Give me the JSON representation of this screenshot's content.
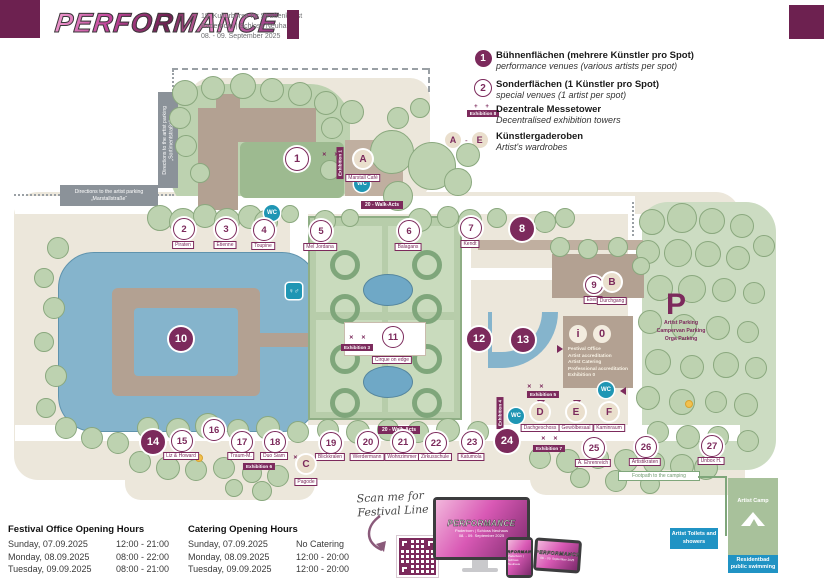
{
  "colors": {
    "purple": "#7c2a5c",
    "teal_wc": "#1f96b4",
    "blue_box": "#2093c4",
    "camp_green": "#a8c19b",
    "water": "#85b4cc"
  },
  "header": {
    "logo_text": "PERFORMANCE",
    "subtitle1": "19. Kulturbörse für Straßenkunst",
    "subtitle2": "Paderborn | Schloss Neuhaus",
    "subtitle3": "08. - 09. September 2025"
  },
  "legend": {
    "items": [
      {
        "symbol": "1",
        "title": "Bühnenflächen (mehrere Künstler pro Spot)",
        "subtitle": "performance venues (various artists per spot)"
      },
      {
        "symbol": "2",
        "title": "Sonderflächen (1 Künstler pro Spot)",
        "subtitle": "special venues (1 artist per spot)"
      },
      {
        "symbol": "Exhibition 8",
        "marks": "+ +",
        "title": "Dezentrale Messetower",
        "subtitle": "Decentralised exhibition towers"
      },
      {
        "symbol_a": "A",
        "symbol_dash": "-",
        "symbol_e": "E",
        "title": "Künstlergaderoben",
        "subtitle": "Artist's wardrobes"
      }
    ]
  },
  "map": {
    "walk_acts_label": "20 - Walk-Acts",
    "walk_acts_badges": [
      {
        "x": 382,
        "y": 201
      },
      {
        "x": 399,
        "y": 426
      }
    ],
    "wc_label": "WC",
    "wc": [
      {
        "x": 272,
        "y": 213
      },
      {
        "x": 362,
        "y": 184
      },
      {
        "x": 516,
        "y": 416
      },
      {
        "x": 606,
        "y": 390
      }
    ],
    "toilet_icon": {
      "x": 294,
      "y": 291,
      "glyphs": "♀♂"
    },
    "spots": [
      {
        "n": "1",
        "x": 296,
        "y": 158,
        "r": 11,
        "filled": false
      },
      {
        "n": "2",
        "x": 183,
        "y": 228,
        "r": 10,
        "filled": false,
        "label": "Piraten",
        "ly": 241
      },
      {
        "n": "3",
        "x": 225,
        "y": 228,
        "r": 10,
        "filled": false,
        "label": "Etienne",
        "ly": 241
      },
      {
        "n": "4",
        "x": 263,
        "y": 229,
        "r": 10,
        "filled": false,
        "label": "Toupine",
        "ly": 242
      },
      {
        "n": "5",
        "x": 320,
        "y": 230,
        "r": 10,
        "filled": false,
        "label": "Mel Jordana",
        "ly": 243
      },
      {
        "n": "6",
        "x": 408,
        "y": 230,
        "r": 10,
        "filled": false,
        "label": "Balagans",
        "ly": 243
      },
      {
        "n": "7",
        "x": 470,
        "y": 227,
        "r": 10,
        "filled": false,
        "label": "Kendt",
        "ly": 240
      },
      {
        "n": "8",
        "x": 521,
        "y": 228,
        "r": 11,
        "filled": true
      },
      {
        "n": "9",
        "x": 593,
        "y": 284,
        "r": 8,
        "filled": false,
        "label": "Exent",
        "ly": 296
      },
      {
        "n": "10",
        "x": 180,
        "y": 338,
        "r": 11,
        "filled": true
      },
      {
        "n": "11",
        "x": 392,
        "y": 336,
        "r": 10,
        "filled": false,
        "label": "Cirque on edge",
        "ly": 356
      },
      {
        "n": "12",
        "x": 478,
        "y": 338,
        "r": 11,
        "filled": true
      },
      {
        "n": "13",
        "x": 522,
        "y": 339,
        "r": 11,
        "filled": true
      },
      {
        "n": "14",
        "x": 152,
        "y": 441,
        "r": 11,
        "filled": true
      },
      {
        "n": "15",
        "x": 181,
        "y": 440,
        "r": 10,
        "filled": false,
        "label": "Liz & Howard",
        "ly": 452
      },
      {
        "n": "16",
        "x": 213,
        "y": 429,
        "r": 10,
        "filled": false
      },
      {
        "n": "17",
        "x": 241,
        "y": 441,
        "r": 10,
        "filled": false,
        "label": "Traum-M.",
        "ly": 452
      },
      {
        "n": "18",
        "x": 274,
        "y": 441,
        "r": 10,
        "filled": false,
        "label": "Duo Siam",
        "ly": 452
      },
      {
        "n": "19",
        "x": 330,
        "y": 442,
        "r": 10,
        "filled": false,
        "label": "Blickkralen",
        "ly": 453
      },
      {
        "n": "20",
        "x": 367,
        "y": 441,
        "r": 10,
        "filled": false,
        "label": "Werdermann",
        "ly": 453
      },
      {
        "n": "21",
        "x": 402,
        "y": 441,
        "r": 10,
        "filled": false,
        "label": "Wohnzimmer",
        "ly": 453
      },
      {
        "n": "22",
        "x": 435,
        "y": 442,
        "r": 10,
        "filled": false,
        "label": "Zirkusschule",
        "ly": 453
      },
      {
        "n": "23",
        "x": 471,
        "y": 441,
        "r": 10,
        "filled": false,
        "label": "Katumola",
        "ly": 453
      },
      {
        "n": "24",
        "x": 506,
        "y": 440,
        "r": 11,
        "filled": true
      },
      {
        "n": "25",
        "x": 593,
        "y": 447,
        "r": 10,
        "filled": false,
        "label": "A. Ehrenreich",
        "ly": 459
      },
      {
        "n": "26",
        "x": 645,
        "y": 446,
        "r": 10,
        "filled": false,
        "label": "Artistikraten",
        "ly": 458
      },
      {
        "n": "27",
        "x": 711,
        "y": 445,
        "r": 10,
        "filled": false,
        "label": "Unbox H.",
        "ly": 457
      }
    ],
    "wardrobes": [
      {
        "l": "A",
        "x": 363,
        "y": 159,
        "label": "Marstall Café",
        "ly": 174
      },
      {
        "l": "B",
        "x": 612,
        "y": 282,
        "label": "Durchgang",
        "ly": 297
      },
      {
        "l": "C",
        "x": 306,
        "y": 464,
        "label": "Pagode",
        "ly": 478
      },
      {
        "l": "D",
        "x": 540,
        "y": 412,
        "label": "Dachgeschoss",
        "ly": 424
      },
      {
        "l": "E",
        "x": 576,
        "y": 412,
        "label": "Gewölbesaal",
        "ly": 424
      },
      {
        "l": "F",
        "x": 609,
        "y": 412,
        "label": "Kaminraum",
        "ly": 424
      }
    ],
    "exhibitions": [
      {
        "label": "Exhibition 1",
        "x": 340,
        "y": 147,
        "vert": true
      },
      {
        "label": "Exhibition 3",
        "x": 357,
        "y": 344
      },
      {
        "label": "Exhibition 4",
        "x": 500,
        "y": 397,
        "vert": true
      },
      {
        "label": "Exhibition 5",
        "x": 543,
        "y": 391
      },
      {
        "label": "Exhibition 6",
        "x": 259,
        "y": 463
      },
      {
        "label": "Exhibition 7",
        "x": 549,
        "y": 445
      }
    ],
    "xmarks": [
      {
        "x": 322,
        "y": 152
      },
      {
        "x": 349,
        "y": 335
      },
      {
        "x": 527,
        "y": 384
      },
      {
        "x": 281,
        "y": 455
      },
      {
        "x": 541,
        "y": 436
      }
    ],
    "arrows": [
      {
        "x": 557,
        "y": 345,
        "dir": "right"
      },
      {
        "x": 620,
        "y": 387,
        "dir": "left"
      },
      {
        "x": 537,
        "y": 400,
        "dir": "down"
      },
      {
        "x": 573,
        "y": 400,
        "dir": "down"
      }
    ],
    "dots": [
      {
        "x": 195,
        "y": 454
      },
      {
        "x": 732,
        "y": 483
      },
      {
        "x": 685,
        "y": 400
      }
    ],
    "info": {
      "letters": [
        "i",
        "0"
      ],
      "lines": [
        "Festival Office",
        "Artist accreditation",
        "Artist Catering",
        "Professional accreditation",
        "Exhibition 0"
      ]
    },
    "parking": {
      "symbol": "P",
      "line1": "Artist Parking",
      "line2": "Campervan Parking",
      "line3": "Orga Parking"
    },
    "dir_sortiment": {
      "line1": "Directions to the artist parking",
      "line2": "„Sortimentstraße“"
    },
    "dir_marstall": {
      "line1": "Directions to the artist parking",
      "line2": "„Marstallstraße“"
    },
    "footpath_label": "Footpath to the camping",
    "artist_camp": "Artist Camp",
    "artist_toilets": "Artist Toilets and showers",
    "residentbad": "Residentbad public swimming",
    "trees": [
      [
        185,
        93,
        13
      ],
      [
        213,
        88,
        12
      ],
      [
        243,
        86,
        13
      ],
      [
        272,
        90,
        12
      ],
      [
        300,
        94,
        12
      ],
      [
        326,
        103,
        12
      ],
      [
        352,
        112,
        12
      ],
      [
        180,
        118,
        11
      ],
      [
        332,
        128,
        11
      ],
      [
        186,
        146,
        11
      ],
      [
        200,
        173,
        10
      ],
      [
        330,
        170,
        10
      ],
      [
        398,
        118,
        11
      ],
      [
        420,
        108,
        10
      ],
      [
        392,
        152,
        22
      ],
      [
        432,
        166,
        24
      ],
      [
        398,
        196,
        15
      ],
      [
        458,
        182,
        14
      ],
      [
        468,
        155,
        12
      ],
      [
        160,
        218,
        13
      ],
      [
        183,
        222,
        14
      ],
      [
        205,
        216,
        12
      ],
      [
        227,
        221,
        13
      ],
      [
        250,
        217,
        12
      ],
      [
        266,
        222,
        12
      ],
      [
        290,
        214,
        9
      ],
      [
        325,
        221,
        11
      ],
      [
        350,
        218,
        9
      ],
      [
        420,
        220,
        12
      ],
      [
        448,
        217,
        11
      ],
      [
        470,
        221,
        12
      ],
      [
        497,
        218,
        10
      ],
      [
        545,
        222,
        11
      ],
      [
        565,
        218,
        10
      ],
      [
        652,
        222,
        13
      ],
      [
        682,
        218,
        15
      ],
      [
        712,
        221,
        13
      ],
      [
        742,
        226,
        12
      ],
      [
        764,
        246,
        11
      ],
      [
        648,
        252,
        12
      ],
      [
        678,
        253,
        14
      ],
      [
        708,
        254,
        13
      ],
      [
        738,
        258,
        12
      ],
      [
        660,
        288,
        13
      ],
      [
        692,
        289,
        14
      ],
      [
        724,
        290,
        12
      ],
      [
        754,
        293,
        11
      ],
      [
        650,
        322,
        12
      ],
      [
        684,
        327,
        13
      ],
      [
        718,
        328,
        12
      ],
      [
        748,
        332,
        11
      ],
      [
        658,
        362,
        13
      ],
      [
        692,
        367,
        12
      ],
      [
        726,
        365,
        13
      ],
      [
        756,
        368,
        11
      ],
      [
        648,
        398,
        12
      ],
      [
        682,
        402,
        13
      ],
      [
        716,
        402,
        11
      ],
      [
        746,
        405,
        12
      ],
      [
        658,
        432,
        11
      ],
      [
        688,
        437,
        12
      ],
      [
        718,
        437,
        11
      ],
      [
        748,
        441,
        11
      ],
      [
        58,
        248,
        11
      ],
      [
        44,
        278,
        10
      ],
      [
        54,
        308,
        11
      ],
      [
        44,
        342,
        10
      ],
      [
        56,
        376,
        11
      ],
      [
        46,
        408,
        10
      ],
      [
        66,
        428,
        11
      ],
      [
        92,
        438,
        11
      ],
      [
        118,
        443,
        11
      ],
      [
        148,
        428,
        11
      ],
      [
        178,
        430,
        12
      ],
      [
        208,
        426,
        13
      ],
      [
        238,
        430,
        11
      ],
      [
        268,
        428,
        12
      ],
      [
        298,
        432,
        11
      ],
      [
        328,
        430,
        11
      ],
      [
        358,
        432,
        12
      ],
      [
        388,
        430,
        11
      ],
      [
        418,
        432,
        11
      ],
      [
        448,
        430,
        12
      ],
      [
        478,
        432,
        11
      ],
      [
        140,
        462,
        11
      ],
      [
        168,
        468,
        12
      ],
      [
        196,
        470,
        11
      ],
      [
        224,
        468,
        11
      ],
      [
        252,
        473,
        10
      ],
      [
        278,
        476,
        11
      ],
      [
        234,
        488,
        9
      ],
      [
        262,
        491,
        10
      ],
      [
        540,
        458,
        11
      ],
      [
        568,
        461,
        12
      ],
      [
        598,
        458,
        11
      ],
      [
        626,
        461,
        12
      ],
      [
        654,
        463,
        11
      ],
      [
        682,
        466,
        12
      ],
      [
        706,
        468,
        12
      ],
      [
        580,
        478,
        10
      ],
      [
        616,
        481,
        11
      ],
      [
        650,
        484,
        10
      ],
      [
        560,
        247,
        10
      ],
      [
        588,
        249,
        10
      ],
      [
        618,
        247,
        10
      ],
      [
        641,
        266,
        9
      ]
    ]
  },
  "hours": {
    "festival_office": {
      "title": "Festival Office Opening Hours",
      "rows": [
        [
          "Sunday, 07.09.2025",
          "12:00 - 21:00"
        ],
        [
          "Monday, 08.09.2025",
          "08:00 - 22:00"
        ],
        [
          "Tuesday, 09.09.2025",
          "08:00 - 21:00"
        ]
      ]
    },
    "catering": {
      "title": "Catering Opening Hours",
      "rows": [
        [
          "Sunday, 07.09.2025",
          "No Catering"
        ],
        [
          "Monday, 08.09.2025",
          "12:00 - 20:00"
        ],
        [
          "Tuesday, 09.09.2025",
          "12:00 - 20:00"
        ]
      ]
    }
  },
  "scan": {
    "line1": "Scan me for",
    "line2": "Festival Line Up",
    "screen_logo": "PERFORMANCE",
    "screen_sub1": "Paderborn | Schloss Neuhaus",
    "screen_sub2": "08. - 09. September 2025"
  }
}
